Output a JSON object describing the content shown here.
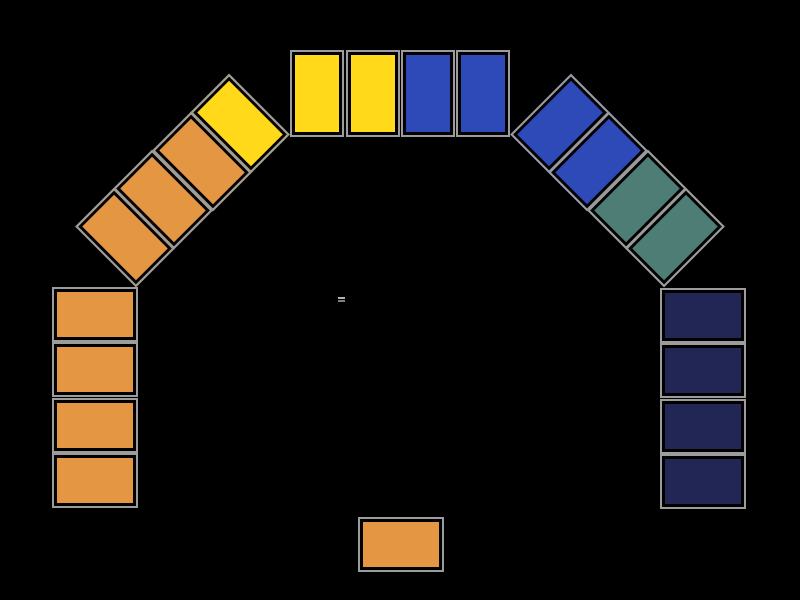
{
  "scene": {
    "name": "tile-arch-game-board",
    "width": 800,
    "height": 600,
    "background": "#000000"
  },
  "palette": {
    "orange": "#E59643",
    "yellow": "#FFD91A",
    "blue": "#2E4AB8",
    "teal": "#4D7D75",
    "navy": "#212655",
    "tile_frame_outer": "#9C9C9C",
    "tile_frame_inner": "#000000"
  },
  "tile_style": {
    "outer_border_px": 2,
    "inner_border_px": 3
  },
  "equals_mark": {
    "glyph": "=",
    "x": 338,
    "y": 297,
    "top_color": "#B3B3B3",
    "bottom_color": "#7F7F7F"
  },
  "tiles": [
    {
      "id": "left-col-1",
      "group": "left-column",
      "color": "orange",
      "x": 52,
      "y": 287,
      "w": 86,
      "h": 55,
      "rot": 0
    },
    {
      "id": "left-col-2",
      "group": "left-column",
      "color": "orange",
      "x": 52,
      "y": 342,
      "w": 86,
      "h": 55,
      "rot": 0
    },
    {
      "id": "left-col-3",
      "group": "left-column",
      "color": "orange",
      "x": 52,
      "y": 398,
      "w": 86,
      "h": 55,
      "rot": 0
    },
    {
      "id": "left-col-4",
      "group": "left-column",
      "color": "orange",
      "x": 52,
      "y": 453,
      "w": 86,
      "h": 55,
      "rot": 0
    },
    {
      "id": "left-diag-1",
      "group": "left-diagonal",
      "color": "orange",
      "x": 82,
      "y": 210,
      "w": 86,
      "h": 55,
      "rot": 45
    },
    {
      "id": "left-diag-2",
      "group": "left-diagonal",
      "color": "orange",
      "x": 120,
      "y": 172,
      "w": 86,
      "h": 55,
      "rot": 45
    },
    {
      "id": "left-diag-3",
      "group": "left-diagonal",
      "color": "orange",
      "x": 159,
      "y": 134,
      "w": 86,
      "h": 55,
      "rot": 45
    },
    {
      "id": "left-diag-4",
      "group": "left-diagonal",
      "color": "yellow",
      "x": 197,
      "y": 96,
      "w": 86,
      "h": 55,
      "rot": 45
    },
    {
      "id": "top-row-1",
      "group": "top-row",
      "color": "yellow",
      "x": 290,
      "y": 50,
      "w": 54,
      "h": 87,
      "rot": 0
    },
    {
      "id": "top-row-2",
      "group": "top-row",
      "color": "yellow",
      "x": 346,
      "y": 50,
      "w": 54,
      "h": 87,
      "rot": 0
    },
    {
      "id": "top-row-3",
      "group": "top-row",
      "color": "blue",
      "x": 401,
      "y": 50,
      "w": 54,
      "h": 87,
      "rot": 0
    },
    {
      "id": "top-row-4",
      "group": "top-row",
      "color": "blue",
      "x": 456,
      "y": 50,
      "w": 54,
      "h": 87,
      "rot": 0
    },
    {
      "id": "right-diag-1",
      "group": "right-diagonal",
      "color": "blue",
      "x": 517,
      "y": 96,
      "w": 86,
      "h": 55,
      "rot": -45
    },
    {
      "id": "right-diag-2",
      "group": "right-diagonal",
      "color": "blue",
      "x": 555,
      "y": 134,
      "w": 86,
      "h": 55,
      "rot": -45
    },
    {
      "id": "right-diag-3",
      "group": "right-diagonal",
      "color": "teal",
      "x": 594,
      "y": 172,
      "w": 86,
      "h": 55,
      "rot": -45
    },
    {
      "id": "right-diag-4",
      "group": "right-diagonal",
      "color": "teal",
      "x": 632,
      "y": 210,
      "w": 86,
      "h": 55,
      "rot": -45
    },
    {
      "id": "right-col-1",
      "group": "right-column",
      "color": "navy",
      "x": 660,
      "y": 288,
      "w": 86,
      "h": 55,
      "rot": 0
    },
    {
      "id": "right-col-2",
      "group": "right-column",
      "color": "navy",
      "x": 660,
      "y": 343,
      "w": 86,
      "h": 55,
      "rot": 0
    },
    {
      "id": "right-col-3",
      "group": "right-column",
      "color": "navy",
      "x": 660,
      "y": 399,
      "w": 86,
      "h": 55,
      "rot": 0
    },
    {
      "id": "right-col-4",
      "group": "right-column",
      "color": "navy",
      "x": 660,
      "y": 454,
      "w": 86,
      "h": 55,
      "rot": 0
    },
    {
      "id": "bottom-center",
      "group": "bottom-center",
      "color": "orange",
      "x": 358,
      "y": 517,
      "w": 86,
      "h": 55,
      "rot": 0
    }
  ]
}
